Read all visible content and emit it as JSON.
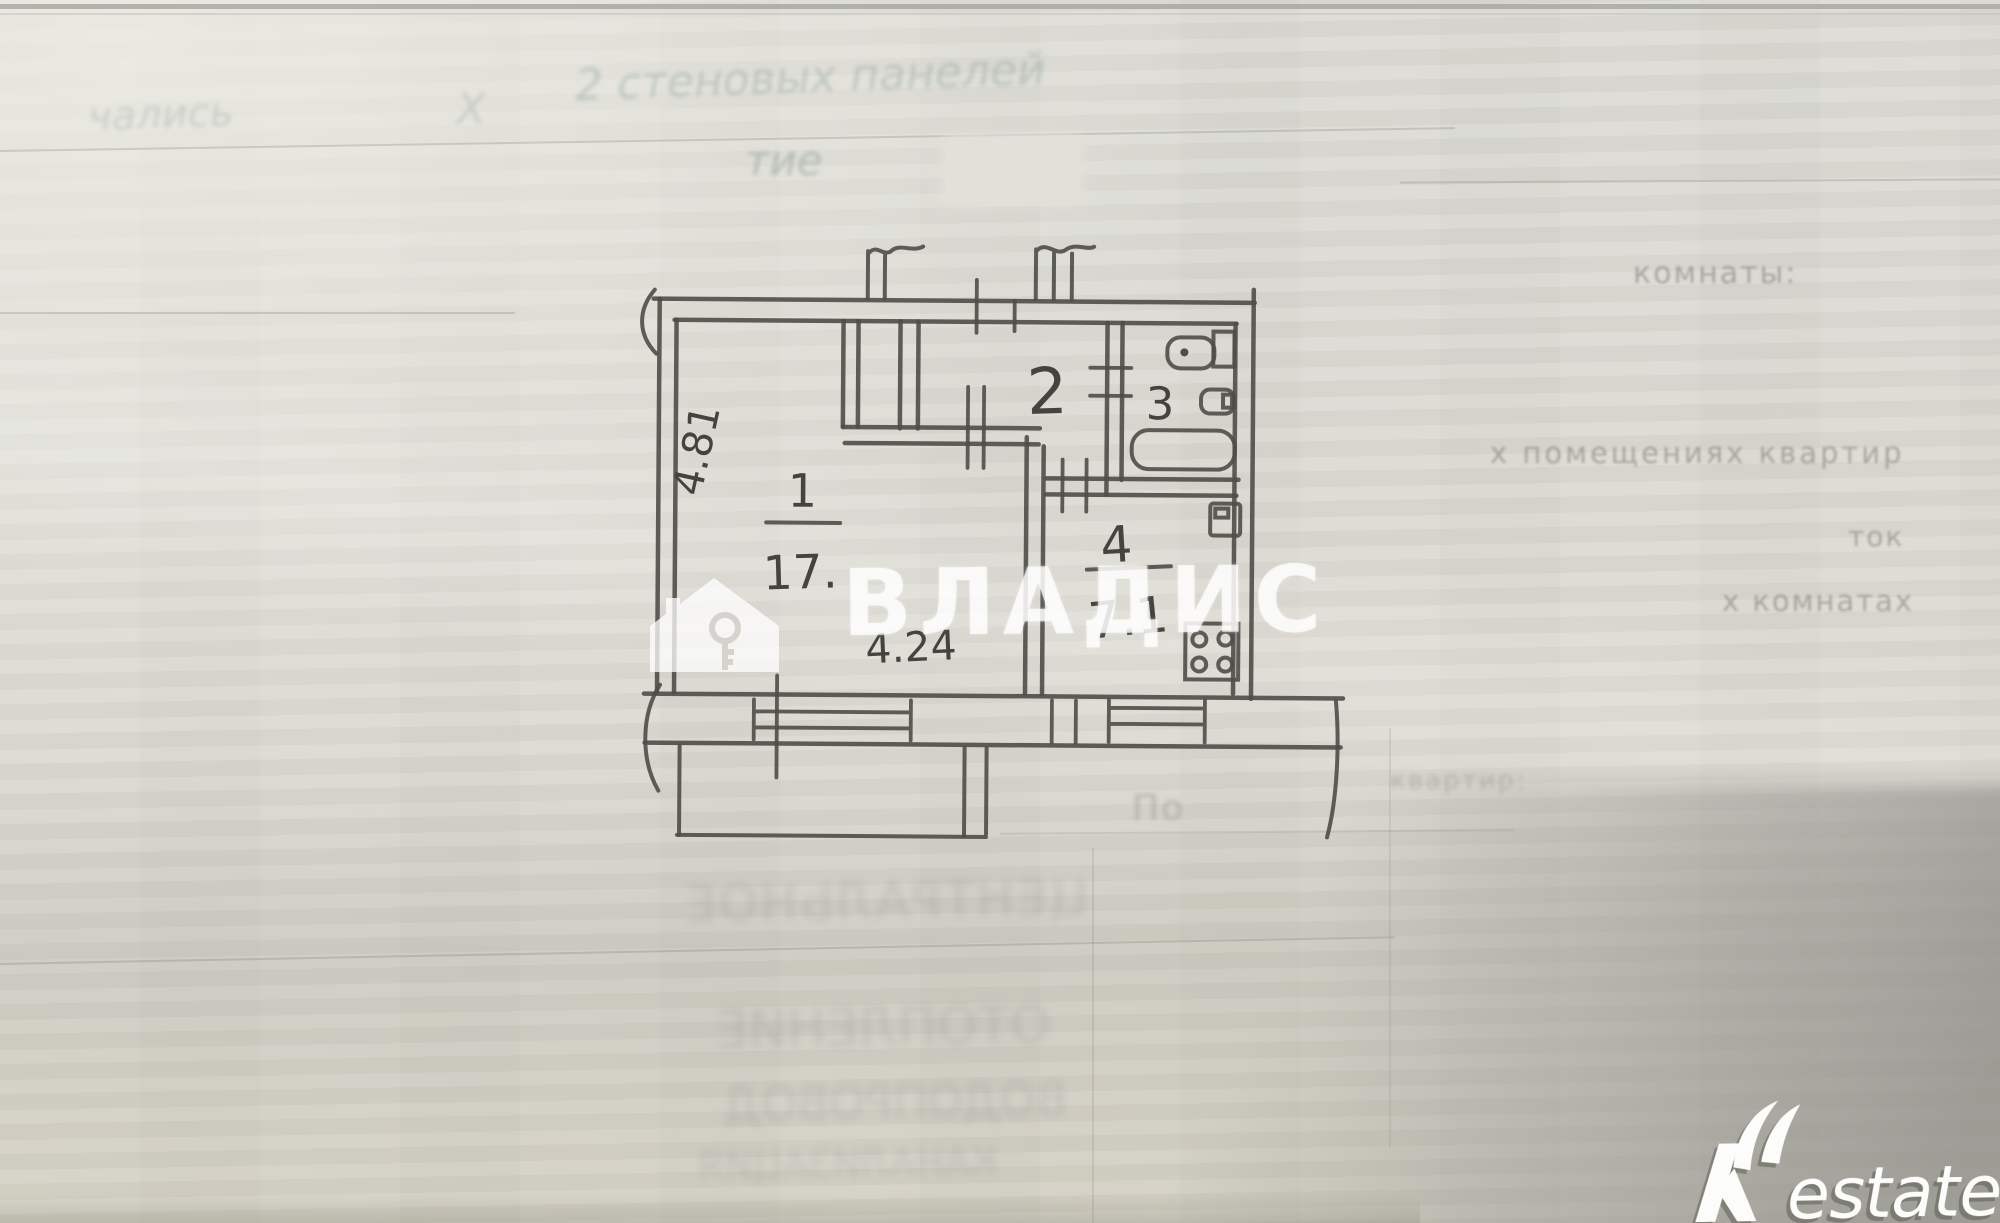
{
  "watermark": {
    "brand": "ВЛАДИС",
    "icon": "house-key-icon"
  },
  "logo": {
    "brand": "Restate",
    "r": "R",
    "suffix": "estate"
  },
  "plan": {
    "type": "apartment-floor-plan",
    "rooms": [
      {
        "number": "1",
        "type": "living-room",
        "area_label": "17.",
        "width_label": "4.24",
        "height_label": "4.81"
      },
      {
        "number": "2",
        "type": "hallway"
      },
      {
        "number": "3",
        "type": "bathroom",
        "fixtures": [
          "toilet",
          "sink",
          "bathtub"
        ]
      },
      {
        "number": "4",
        "type": "kitchen",
        "area_label": "7.1",
        "fixtures": [
          "sink",
          "stove"
        ]
      }
    ]
  },
  "paper": {
    "faint_texts": {
      "handwriting_left": "чались",
      "handwriting_left2": "Х",
      "handwriting_top": "2 стеновых панелей",
      "handwriting_mid": "тие",
      "label_rooms": "комнаты:",
      "label_premises": "х помещениях квартир",
      "label_tok": "ток",
      "label_komnatah": "х комнатах",
      "label_po": "По",
      "label_kvartir": "квартир:",
      "bleed_row_1": "ЦЕНТРАЛЬНОЕ",
      "bleed_row_2": "ОТОПЛЕНИЕ",
      "bleed_row_3": "ВОДОПРОВОД",
      "bleed_row_4": "КАНАЛИЗАЦИЯ"
    }
  }
}
